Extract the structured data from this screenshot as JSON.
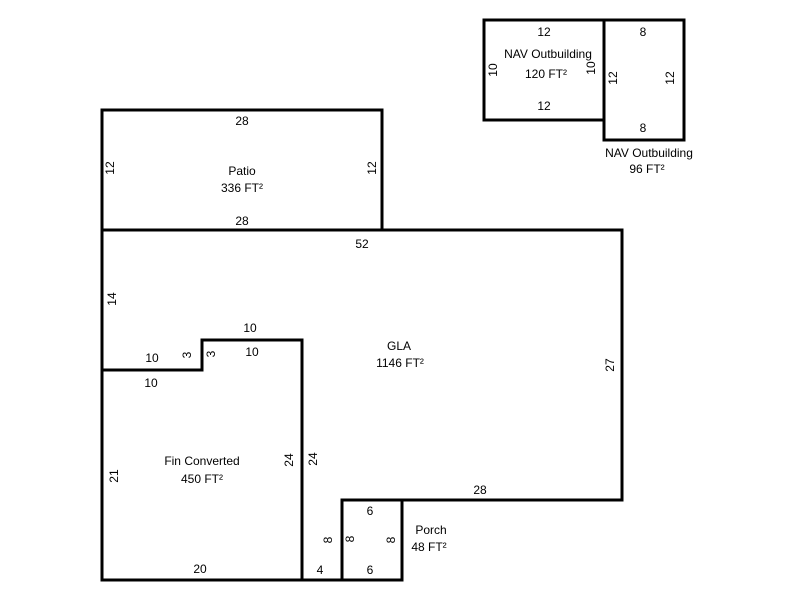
{
  "canvas": {
    "width": 800,
    "height": 600,
    "background": "#ffffff",
    "line_color": "#000000",
    "line_width": 3,
    "text_color": "#000000"
  },
  "floor_plan": {
    "scale_px_per_ft": 10,
    "areas": [
      {
        "id": "patio",
        "name": "Patio",
        "area": "336 FT²",
        "points": [
          [
            102,
            110
          ],
          [
            382,
            110
          ],
          [
            382,
            230
          ],
          [
            102,
            230
          ]
        ],
        "labels": [
          {
            "text": "Patio",
            "x": 242,
            "y": 171
          },
          {
            "text": "336 FT²",
            "x": 242,
            "y": 188
          }
        ],
        "dims": [
          {
            "text": "28",
            "x": 242,
            "y": 121
          },
          {
            "text": "12",
            "x": 110,
            "y": 168,
            "rot": -90
          },
          {
            "text": "12",
            "x": 372,
            "y": 168,
            "rot": -90
          },
          {
            "text": "28",
            "x": 242,
            "y": 221
          }
        ]
      },
      {
        "id": "gla",
        "name": "GLA",
        "area": "1146 FT²",
        "points": [
          [
            102,
            230
          ],
          [
            622,
            230
          ],
          [
            622,
            500
          ],
          [
            342,
            500
          ],
          [
            342,
            580
          ],
          [
            302,
            580
          ],
          [
            302,
            340
          ],
          [
            202,
            340
          ],
          [
            202,
            370
          ],
          [
            102,
            370
          ]
        ],
        "labels": [
          {
            "text": "GLA",
            "x": 399,
            "y": 346
          },
          {
            "text": "1146 FT²",
            "x": 400,
            "y": 363
          }
        ],
        "dims": [
          {
            "text": "52",
            "x": 362,
            "y": 244
          },
          {
            "text": "14",
            "x": 112,
            "y": 299,
            "rot": -90
          },
          {
            "text": "10",
            "x": 152,
            "y": 358
          },
          {
            "text": "3",
            "x": 187,
            "y": 355,
            "rot": -90
          },
          {
            "text": "10",
            "x": 250,
            "y": 328
          },
          {
            "text": "24",
            "x": 313,
            "y": 459,
            "rot": -90
          },
          {
            "text": "27",
            "x": 610,
            "y": 365,
            "rot": -90
          },
          {
            "text": "28",
            "x": 480,
            "y": 490
          },
          {
            "text": "8",
            "x": 328,
            "y": 540,
            "rot": -90
          },
          {
            "text": "4",
            "x": 320,
            "y": 570
          }
        ]
      },
      {
        "id": "fin-converted",
        "name": "Fin Converted",
        "area": "450 FT²",
        "points": [
          [
            102,
            370
          ],
          [
            202,
            370
          ],
          [
            202,
            340
          ],
          [
            302,
            340
          ],
          [
            302,
            580
          ],
          [
            102,
            580
          ]
        ],
        "labels": [
          {
            "text": "Fin Converted",
            "x": 202,
            "y": 461
          },
          {
            "text": "450 FT²",
            "x": 202,
            "y": 479
          }
        ],
        "dims": [
          {
            "text": "10",
            "x": 151,
            "y": 383
          },
          {
            "text": "3",
            "x": 211,
            "y": 354,
            "rot": -90
          },
          {
            "text": "10",
            "x": 252,
            "y": 352
          },
          {
            "text": "24",
            "x": 289,
            "y": 460,
            "rot": -90
          },
          {
            "text": "21",
            "x": 114,
            "y": 476,
            "rot": -90
          },
          {
            "text": "20",
            "x": 200,
            "y": 569
          }
        ]
      },
      {
        "id": "porch",
        "name": "Porch",
        "area": "48 FT²",
        "points": [
          [
            342,
            500
          ],
          [
            402,
            500
          ],
          [
            402,
            580
          ],
          [
            342,
            580
          ]
        ],
        "labels": [
          {
            "text": "Porch",
            "x": 431,
            "y": 530
          },
          {
            "text": "48 FT²",
            "x": 429,
            "y": 547
          }
        ],
        "dims": [
          {
            "text": "6",
            "x": 370,
            "y": 511
          },
          {
            "text": "8",
            "x": 350,
            "y": 539,
            "rot": -90
          },
          {
            "text": "8",
            "x": 391,
            "y": 540,
            "rot": -90
          },
          {
            "text": "6",
            "x": 370,
            "y": 570
          }
        ]
      },
      {
        "id": "nav-outbuilding-120",
        "name": "NAV Outbuilding",
        "area": "120 FT²",
        "points": [
          [
            484,
            20
          ],
          [
            604,
            20
          ],
          [
            604,
            120
          ],
          [
            484,
            120
          ]
        ],
        "labels": [
          {
            "text": "NAV Outbuilding",
            "x": 548,
            "y": 54
          },
          {
            "text": "120 FT²",
            "x": 546,
            "y": 74
          }
        ],
        "dims": [
          {
            "text": "12",
            "x": 544,
            "y": 32
          },
          {
            "text": "10",
            "x": 493,
            "y": 70,
            "rot": -90
          },
          {
            "text": "10",
            "x": 591,
            "y": 68,
            "rot": -90
          },
          {
            "text": "12",
            "x": 544,
            "y": 106
          }
        ]
      },
      {
        "id": "nav-outbuilding-96",
        "name": "NAV Outbuilding",
        "area": "96 FT²",
        "points": [
          [
            604,
            20
          ],
          [
            684,
            20
          ],
          [
            684,
            140
          ],
          [
            604,
            140
          ]
        ],
        "labels": [
          {
            "text": "NAV Outbuilding",
            "x": 649,
            "y": 153
          },
          {
            "text": "96 FT²",
            "x": 647,
            "y": 169
          }
        ],
        "dims": [
          {
            "text": "8",
            "x": 643,
            "y": 32
          },
          {
            "text": "12",
            "x": 613,
            "y": 78,
            "rot": -90
          },
          {
            "text": "12",
            "x": 670,
            "y": 78,
            "rot": -90
          },
          {
            "text": "8",
            "x": 643,
            "y": 128
          }
        ]
      }
    ]
  }
}
